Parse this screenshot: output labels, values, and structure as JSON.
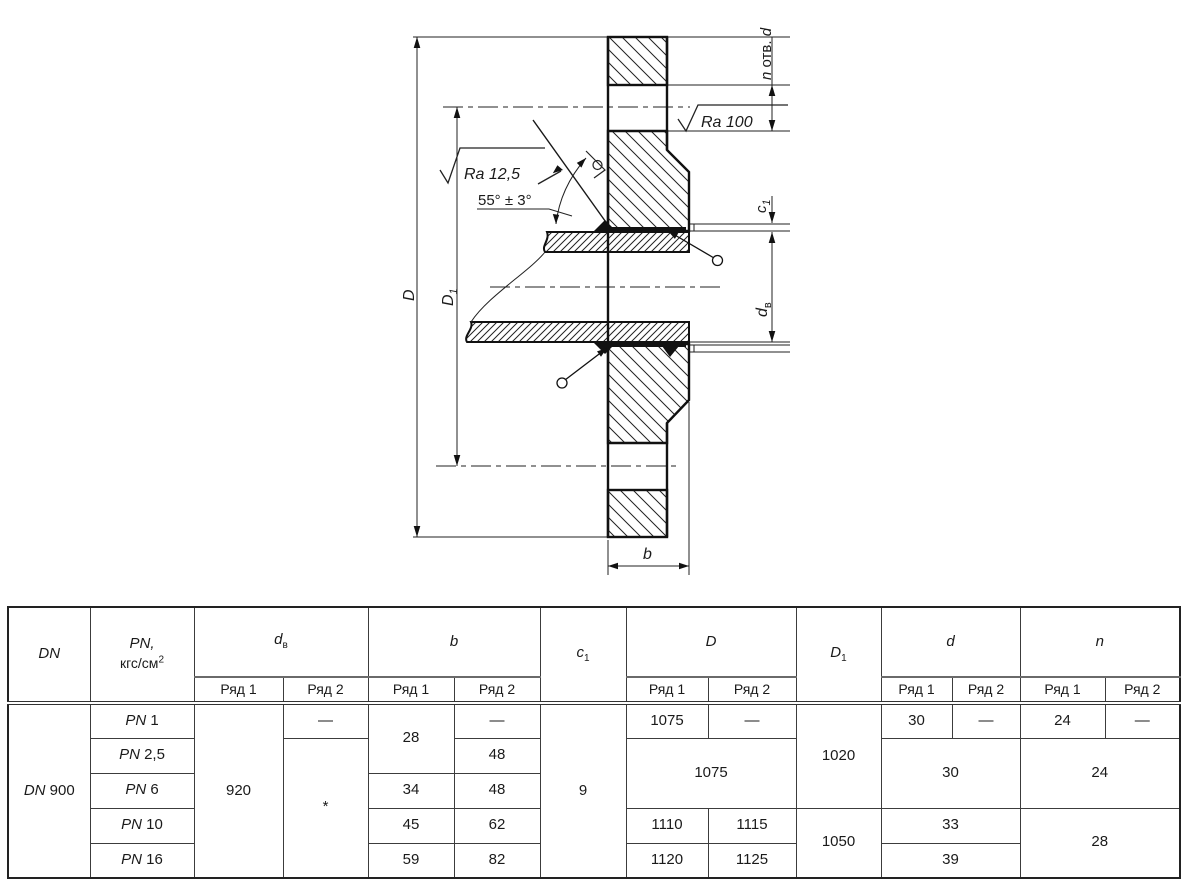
{
  "drawing": {
    "labels": {
      "n_holes_pre": "n",
      "n_holes_mid": " отв. ",
      "n_holes_post": "d",
      "ra_100": "Ra 100",
      "ra_125": "Ra 12,5",
      "angle": "55° ± 3°",
      "dim_D": "D",
      "dim_D1_base": "D",
      "dim_D1_sub": "1",
      "dim_c1_base": "c",
      "dim_c1_sub": "1",
      "dim_dv_base": "d",
      "dim_dv_sub": "в",
      "dim_b": "b"
    }
  },
  "table": {
    "header": {
      "dn": "DN",
      "pn_top": "PN,",
      "pn_unit": "кгс/см",
      "pn_sup": "2",
      "dv_base": "d",
      "dv_sub": "в",
      "b": "b",
      "c1_base": "c",
      "c1_sub": "1",
      "D": "D",
      "D1_base": "D",
      "D1_sub": "1",
      "d": "d",
      "n": "n",
      "ryad1": "Ряд 1",
      "ryad2": "Ряд 2"
    },
    "dn_value": {
      "sym": "DN",
      "num": "900"
    },
    "rows": [
      {
        "pn_sym": "PN",
        "pn_num": "1"
      },
      {
        "pn_sym": "PN",
        "pn_num": "2,5"
      },
      {
        "pn_sym": "PN",
        "pn_num": "6"
      },
      {
        "pn_sym": "PN",
        "pn_num": "10"
      },
      {
        "pn_sym": "PN",
        "pn_num": "16"
      }
    ],
    "cells": {
      "dv1": "920",
      "dv2_r1": "—",
      "dv2_rest": "*",
      "b1_r12": "28",
      "b2_r1": "—",
      "b2_r2": "48",
      "b1_r3": "34",
      "b2_r3": "48",
      "b1_r4": "45",
      "b2_r4": "62",
      "b1_r5": "59",
      "b2_r5": "82",
      "c1": "9",
      "D1_r1": "1075",
      "D2_r1": "—",
      "D_r23": "1075",
      "D1_r4": "1110",
      "D2_r4": "1115",
      "D1_r5": "1120",
      "D2_r5": "1125",
      "Dd1_r123": "1020",
      "Dd1_r45": "1050",
      "d1_r1": "30",
      "d2_r1": "—",
      "d_r23": "30",
      "d_r4": "33",
      "d_r5": "39",
      "n1_r1": "24",
      "n2_r1": "—",
      "n_r23": "24",
      "n_r45": "28"
    }
  }
}
